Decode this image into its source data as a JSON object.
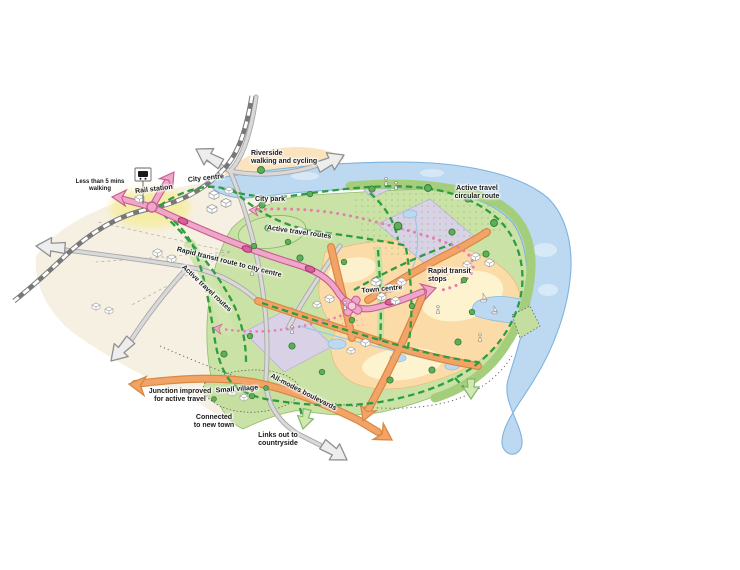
{
  "map": {
    "title": "New town active travel and rapid transit concept map",
    "labels": {
      "less_than_5_mins": "Less than 5 mins\nwalking",
      "rail_station": "Rail station",
      "city_centre": "City centre",
      "riverside": "Riverside\nwalking and cycling",
      "city_park": "City park",
      "active_travel_routes_north": "Active travel routes",
      "rapid_transit_route": "Rapid transit route to city centre",
      "active_travel_routes_west": "Active travel routes",
      "active_travel_circular": "Active travel\ncircular route",
      "rapid_transit_stops": "Rapid transit\nstops",
      "town_centre": "Town centre",
      "all_modes_boulevards": "All-modes boulevards",
      "junction_improved": "Junction improved\nfor active travel",
      "small_village": "Small village",
      "connected_new_town": "Connected\nto new town",
      "links_countryside": "Links out to\ncountryside"
    },
    "features": [
      {
        "name": "river",
        "color": "#BCD9F1"
      },
      {
        "name": "rapid-transit-route",
        "color": "#F0A6C8"
      },
      {
        "name": "rapid-transit-stop",
        "color": "#D9619B"
      },
      {
        "name": "active-travel-route",
        "color": "#2E9C3F"
      },
      {
        "name": "all-modes-boulevard",
        "color": "#F2A468"
      },
      {
        "name": "road",
        "color": "#D9D9D9"
      },
      {
        "name": "railway",
        "color": "#787878"
      },
      {
        "name": "development-parcel",
        "color": "#D9D2E6"
      },
      {
        "name": "green-space",
        "color": "#CBE2A6"
      },
      {
        "name": "town-area",
        "color": "#FBDCA8"
      },
      {
        "name": "walking-catchment-glow",
        "color": "#F5EDA0"
      }
    ],
    "icons": [
      "train-station-icon",
      "tree-icon",
      "building-icon",
      "person-icon",
      "sailboat-icon",
      "road-continues-arrow-icon",
      "boulevard-arrow-icon",
      "transit-arrow-icon",
      "countryside-link-arrow-icon"
    ]
  }
}
